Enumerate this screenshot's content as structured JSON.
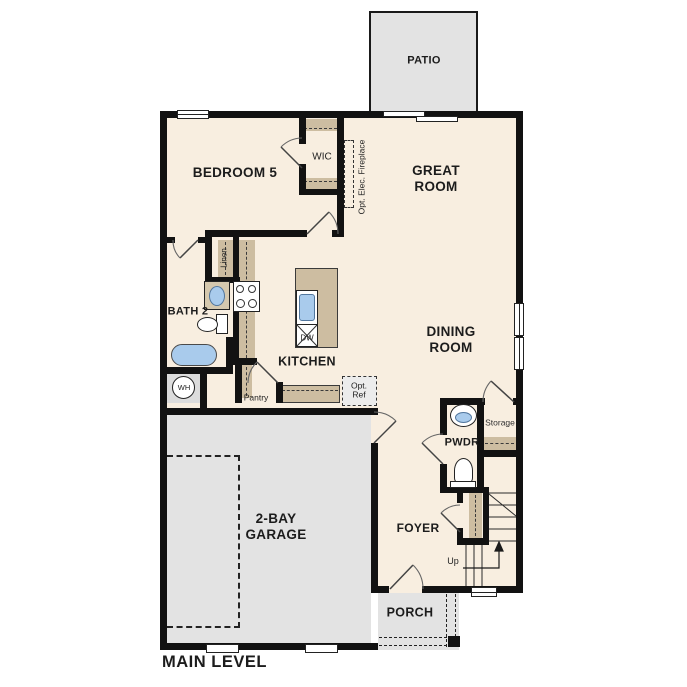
{
  "plan": {
    "title": "MAIN LEVEL",
    "rooms": {
      "patio": "PATIO",
      "bedroom5": "BEDROOM 5",
      "wic": "WIC",
      "great_room": "GREAT\nROOM",
      "dining_room": "DINING\nROOM",
      "kitchen": "KITCHEN",
      "bath2": "BATH 2",
      "pwdr": "PWDR",
      "storage": "Storage",
      "foyer": "FOYER",
      "garage": "2-BAY\nGARAGE",
      "porch": "PORCH"
    },
    "features": {
      "fireplace": "Opt. Elec. Fireplace",
      "linen": "Linen",
      "pantry": "Pantry",
      "opt_ref": "Opt.\nRef",
      "dishwasher": "DW",
      "water_heater": "WH",
      "stairs_up": "Up"
    },
    "colors": {
      "floor": "#f8eee0",
      "outdoor": "#e3e3e3",
      "wall": "#121212",
      "casework": "#cdbda1",
      "fixture_blue": "#a9cbec"
    }
  }
}
